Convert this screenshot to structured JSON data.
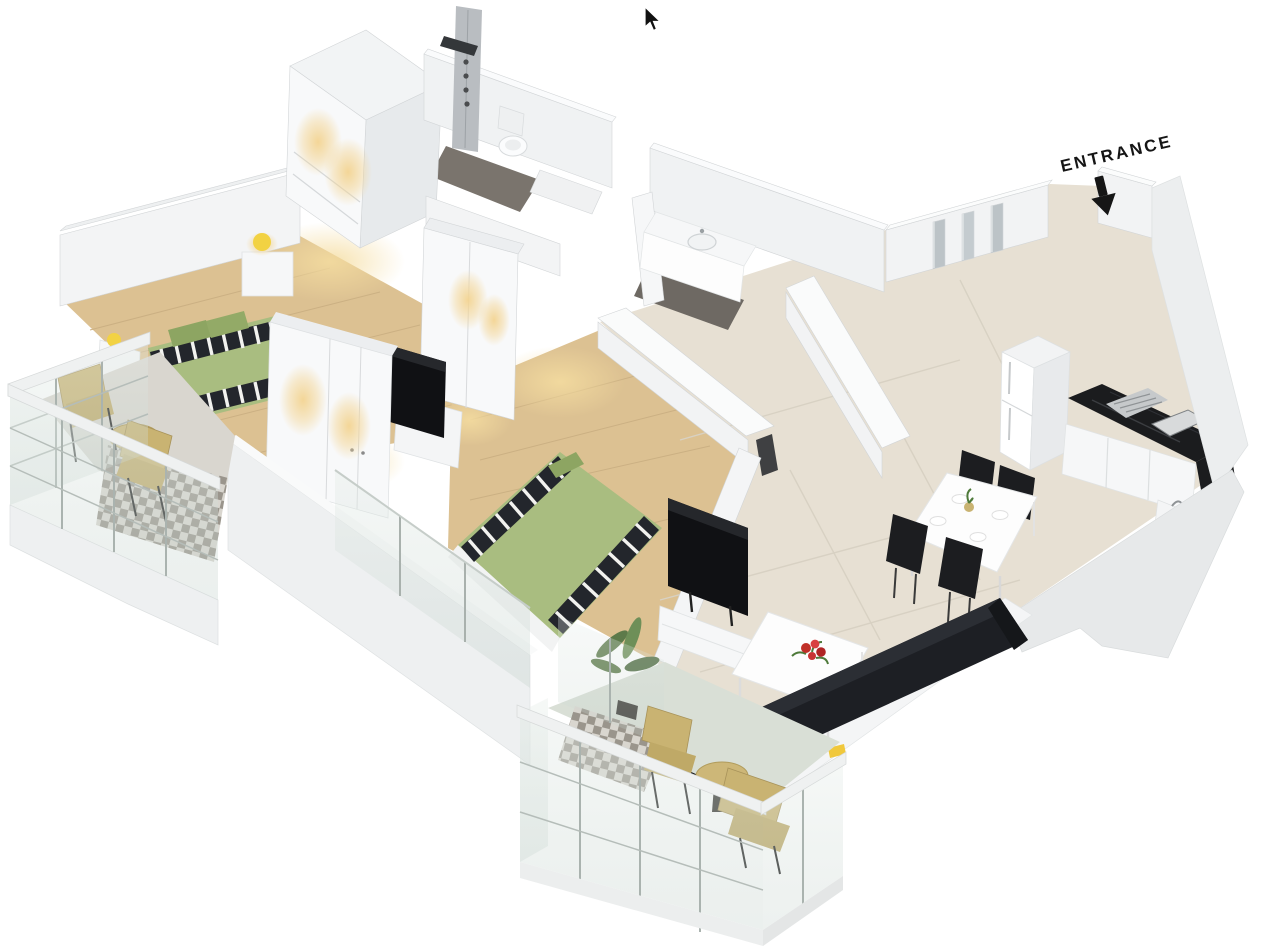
{
  "meta": {
    "kind": "3d-isometric-floor-plan-render",
    "description": "Isometric 3D render of a two-bedroom apartment floor plan on a white background with a mouse cursor visible at top center"
  },
  "labels": {
    "entrance": "ENTRANCE"
  },
  "icons": {
    "cursor": "cursor-icon",
    "entrance_arrow": "entrance-arrow-icon"
  },
  "colors": {
    "background": "#ffffff",
    "wall_white": "#f5f6f7",
    "wall_shade": "#e6e9ea",
    "wall_dark_edge": "#d2d5d7",
    "wood_floor": "#dcc192",
    "wood_floor_lit": "#f3dfa8",
    "tile_floor": "#e7e0d3",
    "tile_seam": "#d8d1c3",
    "bath_floor_dark": "#756f68",
    "bed_green": "#a9bd80",
    "pillow_green": "#8da562",
    "stripe_dark": "#23262c",
    "balcony_furniture_tan": "#c9b372",
    "glass": "#cfdad4",
    "countertop_black": "#1b1c1e",
    "sofa_black": "#1d1f24",
    "tv_black": "#101114",
    "flower_red": "#c03028",
    "lamp_yellow": "#f2d243",
    "warm_light": "#f3d492",
    "plant_green": "#5d7a4a"
  },
  "rooms": [
    {
      "name": "master-bedroom",
      "furniture": [
        "double-bed-green-striped",
        "nightstand-lamp",
        "nightstand-lamp",
        "tv-on-stand",
        "lit-wardrobe"
      ]
    },
    {
      "name": "walk-in-closet",
      "furniture": [
        "lit-wardrobe"
      ]
    },
    {
      "name": "bathroom-1",
      "furniture": [
        "shower-column",
        "toilet"
      ]
    },
    {
      "name": "bathroom-2",
      "furniture": [
        "vanity-sink"
      ]
    },
    {
      "name": "second-bedroom",
      "furniture": [
        "double-bed-green-striped",
        "lit-wardrobe"
      ]
    },
    {
      "name": "entrance-hallway",
      "furniture": [
        "mirrored-closets"
      ]
    },
    {
      "name": "kitchen",
      "furniture": [
        "fridge",
        "black-counter-with-cooktop-sink",
        "white-cabinets"
      ]
    },
    {
      "name": "dining-area",
      "furniture": [
        "white-dining-table",
        "black-chair",
        "black-chair",
        "black-chair",
        "black-chair"
      ]
    },
    {
      "name": "living-room",
      "furniture": [
        "tv-on-white-cabinet",
        "white-coffee-table-red-flowers",
        "black-sofa"
      ]
    },
    {
      "name": "balcony-left",
      "furniture": [
        "bistro-table",
        "tan-chair",
        "tan-chair",
        "checker-tile-floor",
        "glass-railing"
      ]
    },
    {
      "name": "balcony-bottom",
      "furniture": [
        "bistro-table",
        "tan-chair",
        "tan-chair",
        "checker-tile-floor",
        "glass-railing",
        "potted-plant"
      ]
    }
  ]
}
